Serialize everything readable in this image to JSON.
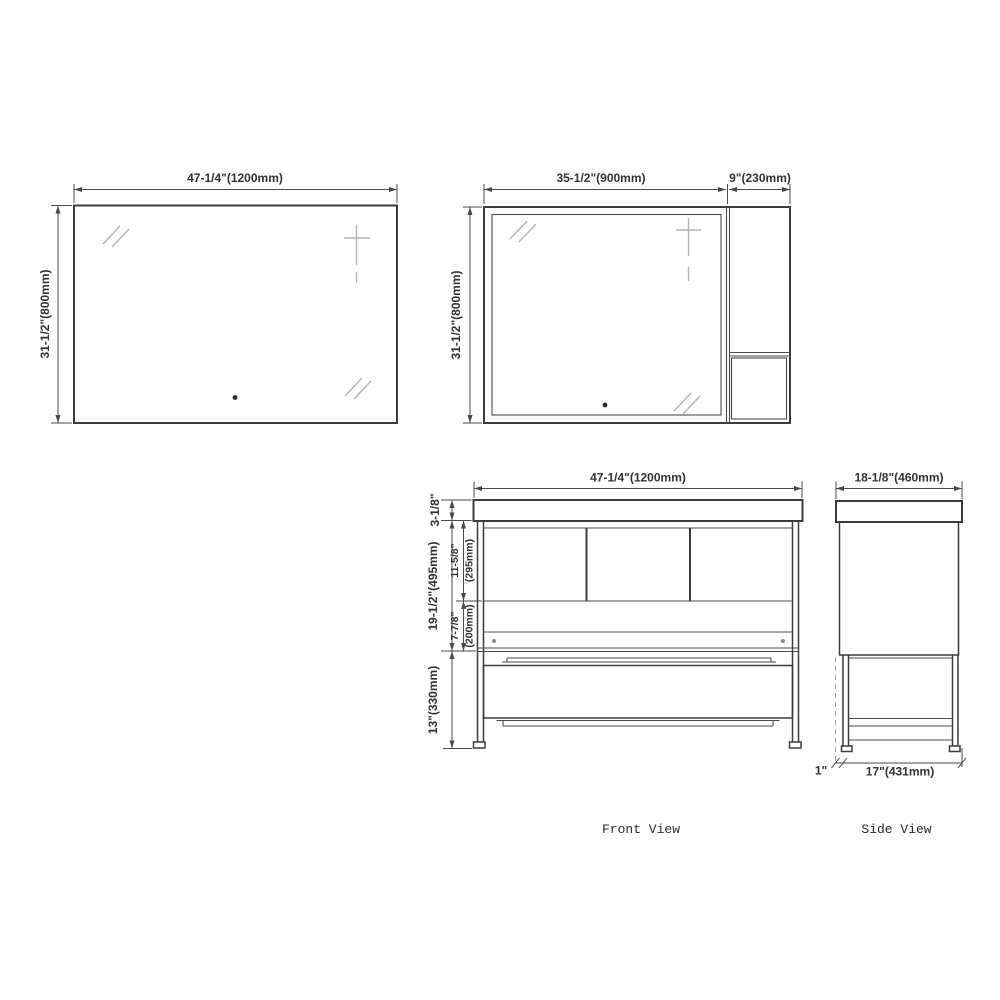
{
  "colors": {
    "outline": "#3c3c3c",
    "dimension_lines": "#4a4a4a",
    "glass_marks": "#b4b4b4",
    "label_text": "#323232",
    "caption_text": "#2b2b2b",
    "background": "#ffffff"
  },
  "single_mirror": {
    "width_label": "47-1/4\"(1200mm)",
    "height_label": "31-1/2\"(800mm)"
  },
  "mirror_with_cabinet": {
    "mirror_width_label": "35-1/2\"(900mm)",
    "cabinet_width_label": "9\"(230mm)",
    "height_label": "31-1/2\"(800mm)"
  },
  "front_view": {
    "caption": "Front View",
    "width_label": "47-1/4\"(1200mm)",
    "counter_height_label": "3-1/8\"",
    "cabinet_height_label": "19-1/2\"(495mm)",
    "doors_height_label": "11-5/8\"",
    "doors_height_mm_label": "(295mm)",
    "drawer_height_label": "7-7/8\"",
    "drawer_height_mm_label": "(200mm)",
    "base_height_label": "13\"(330mm)"
  },
  "side_view": {
    "caption": "Side View",
    "depth_label": "18-1/8\"(460mm)",
    "base_depth_label": "17\"(431mm)",
    "leg_offset_label": "1\""
  }
}
